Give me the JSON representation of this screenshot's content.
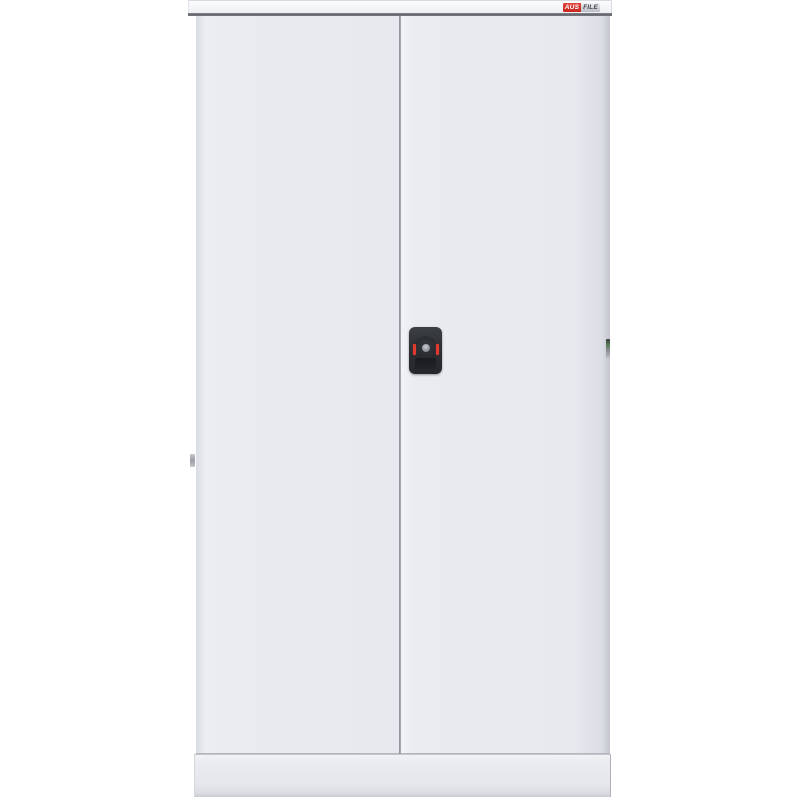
{
  "image": {
    "type": "product-photo",
    "subject": "two-door steel stationery cabinet, front view, closed doors",
    "background_color": "#ffffff"
  },
  "logo": {
    "brand_left": "AUS",
    "brand_right": "FILE"
  },
  "cabinet": {
    "parts": [
      "top-cap",
      "left-door",
      "right-door",
      "door-gap",
      "cam-lock",
      "base-plinth"
    ],
    "lock_red_tick_count": 2
  },
  "colors": {
    "cabinet_body": "#e8eaf0",
    "cabinet_top_cap": "#f4f5f8",
    "plinth": "#e6e8ee",
    "top_seam_dark": "#606369",
    "door_gap_line": "#9a9da3",
    "lock_body": "#2c2f33",
    "lock_dial": "#292c30",
    "lock_knob": "#9198a0",
    "lock_red_tick": "#e23a2e",
    "keyhole_plate": "#1c1e21",
    "logo_red": "#c6271f",
    "logo_silver": "#b9bdc4"
  }
}
